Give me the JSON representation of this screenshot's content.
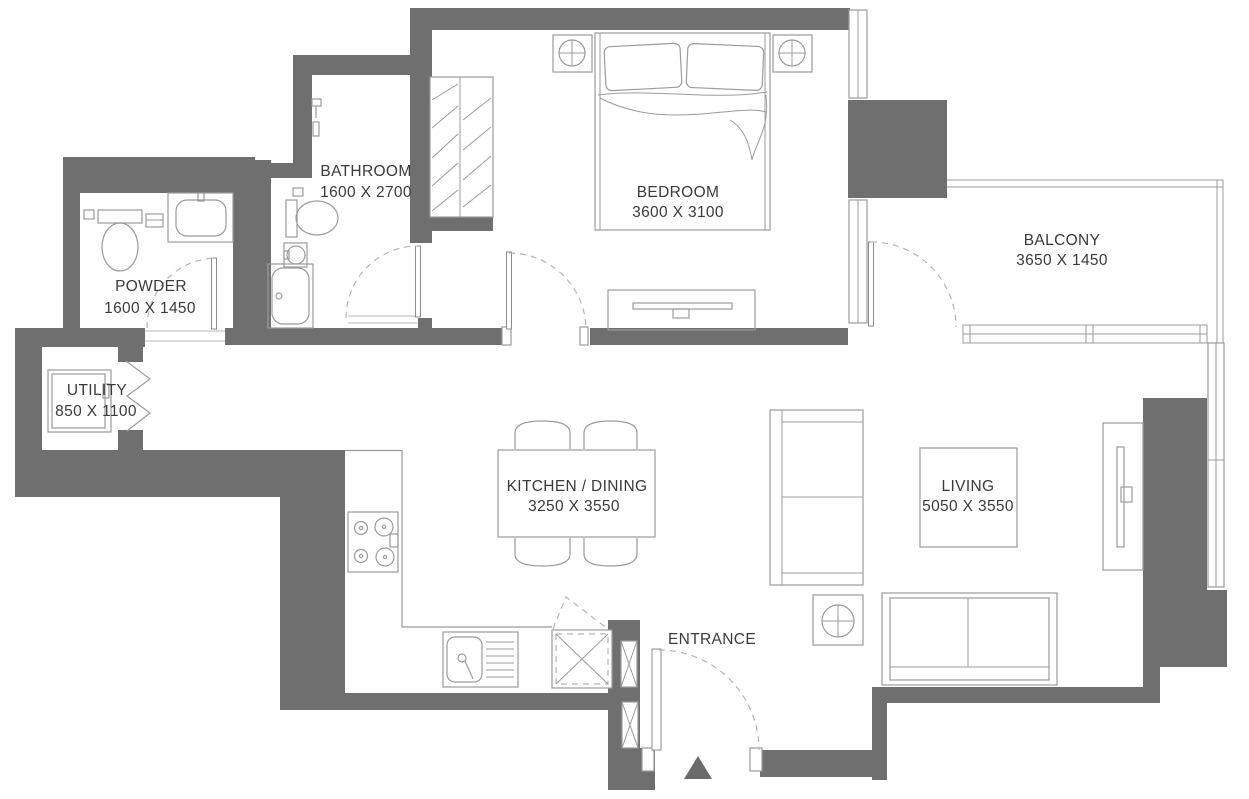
{
  "colors": {
    "wall": "#6F6F6F",
    "furniture_line": "#9B9B9B",
    "door_dash": "#B5B5B5",
    "text": "#3B3B3B",
    "marker": "#6B6B6B",
    "background": "#FFFFFF"
  },
  "rooms": [
    {
      "name": "BATHROOM",
      "dimensions": "1600 X 2700"
    },
    {
      "name": "BEDROOM",
      "dimensions": "3600 X 3100"
    },
    {
      "name": "BALCONY",
      "dimensions": "3650 X 1450"
    },
    {
      "name": "POWDER",
      "dimensions": "1600 X 1450"
    },
    {
      "name": "UTILITY",
      "dimensions": "850 X 1100"
    },
    {
      "name": "KITCHEN / DINING",
      "dimensions": "3250 X 3550"
    },
    {
      "name": "LIVING",
      "dimensions": "5050 X 3550"
    },
    {
      "name": "ENTRANCE",
      "dimensions": ""
    }
  ]
}
